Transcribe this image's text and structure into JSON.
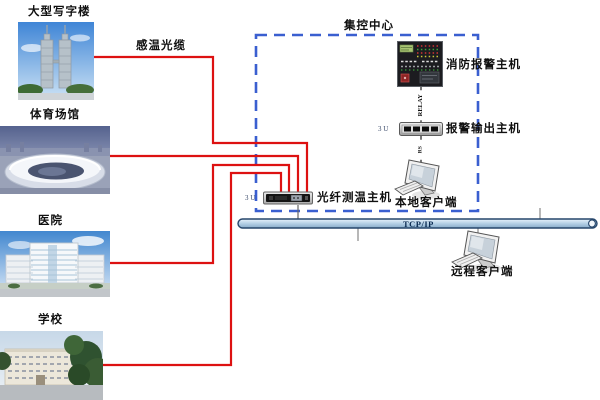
{
  "diagram": {
    "site_labels": {
      "office": "大型写字楼",
      "stadium": "体育场馆",
      "hospital": "医院",
      "school": "学校"
    },
    "cable_label": "感温光缆",
    "control_center": {
      "box_label": "集控中心",
      "fire_alarm_host_label": "消防报警主机",
      "alarm_output_host_label": "报警输出主机",
      "local_client_label": "本地客户端",
      "relay_link_label": "RELAY",
      "serial_link_label": "RS",
      "alarm_output_rack_unit": "3 U"
    },
    "fiber_host": {
      "label": "光纤测温主机",
      "rack_unit": "3 U"
    },
    "network": {
      "bus_label": "TCP/IP",
      "remote_client_label": "远程客户端"
    },
    "colors": {
      "cable_red": "#dd1111",
      "box_blue": "#3a5fd0",
      "bus_border": "#26466b",
      "connector_gray": "#555555"
    }
  }
}
